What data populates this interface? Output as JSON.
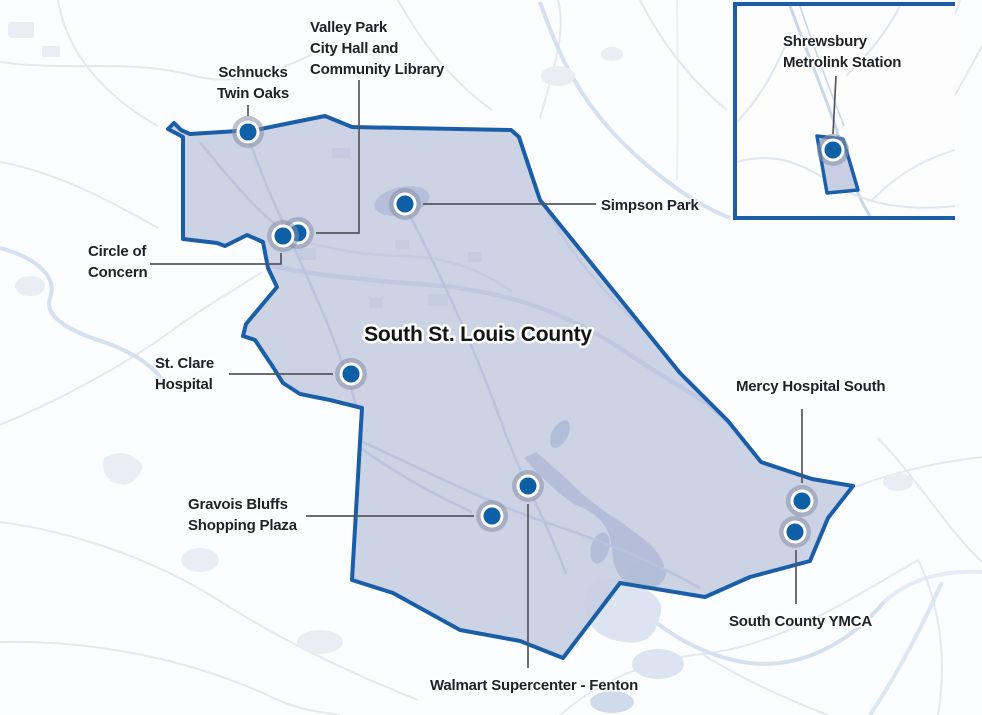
{
  "map": {
    "region": {
      "name": "South St. Louis County",
      "fill_color": "#c8cfe3",
      "border_color": "#1a5ea8",
      "boundary_points": [
        [
          168,
          129
        ],
        [
          174,
          123
        ],
        [
          181,
          130
        ],
        [
          190,
          134
        ],
        [
          238,
          131
        ],
        [
          247,
          136
        ],
        [
          256,
          130
        ],
        [
          290,
          123
        ],
        [
          325,
          116
        ],
        [
          352,
          127
        ],
        [
          511,
          130
        ],
        [
          519,
          137
        ],
        [
          540,
          200
        ],
        [
          680,
          373
        ],
        [
          728,
          421
        ],
        [
          761,
          462
        ],
        [
          812,
          479
        ],
        [
          853,
          486
        ],
        [
          828,
          518
        ],
        [
          810,
          561
        ],
        [
          750,
          577
        ],
        [
          705,
          597
        ],
        [
          620,
          583
        ],
        [
          563,
          658
        ],
        [
          520,
          641
        ],
        [
          460,
          630
        ],
        [
          393,
          593
        ],
        [
          352,
          580
        ],
        [
          362,
          408
        ],
        [
          330,
          400
        ],
        [
          300,
          394
        ],
        [
          283,
          383
        ],
        [
          273,
          367
        ],
        [
          255,
          340
        ],
        [
          243,
          336
        ],
        [
          246,
          324
        ],
        [
          277,
          287
        ],
        [
          268,
          268
        ],
        [
          263,
          242
        ],
        [
          247,
          235
        ],
        [
          225,
          246
        ],
        [
          217,
          243
        ],
        [
          183,
          239
        ],
        [
          183,
          137
        ]
      ]
    },
    "marker_style": {
      "dot_color": "#0d5fa6",
      "ring_color": "#ffffff",
      "halo_color": "rgba(134,143,167,0.55)",
      "dot_radius": 8.5,
      "ring_radius": 11.5,
      "halo_radius": 16
    },
    "leader_color": "#55585c",
    "label_color": "#1f2124",
    "markers": [
      {
        "id": "schnucks-twin-oaks",
        "label_lines": [
          "Schnucks",
          "Twin Oaks"
        ],
        "x": 248,
        "y": 132,
        "label_x": 253,
        "label_y": 77,
        "anchor": "middle",
        "leader": "248,105 248,116"
      },
      {
        "id": "valley-park-city-hall",
        "label_lines": [
          "Valley Park",
          "City Hall and",
          "Community Library"
        ],
        "x": 298,
        "y": 233,
        "label_x": 310,
        "label_y": 32,
        "anchor": "start",
        "leader": "359,80 359,233 316,233"
      },
      {
        "id": "simpson-park",
        "label_lines": [
          "Simpson Park"
        ],
        "x": 405,
        "y": 204,
        "label_x": 601,
        "label_y": 210,
        "anchor": "start",
        "leader": "423,204 596,204"
      },
      {
        "id": "circle-of-concern",
        "label_lines": [
          "Circle of",
          "Concern"
        ],
        "x": 283,
        "y": 236,
        "label_x": 88,
        "label_y": 256,
        "anchor": "start",
        "leader": "150,264 281,264 281,253"
      },
      {
        "id": "st-clare-hospital",
        "label_lines": [
          "St. Clare",
          "Hospital"
        ],
        "x": 351,
        "y": 374,
        "label_x": 155,
        "label_y": 368,
        "anchor": "start",
        "leader": "229,374 333,374"
      },
      {
        "id": "gravois-bluffs-shopping-plaza",
        "label_lines": [
          "Gravois Bluffs",
          "Shopping Plaza"
        ],
        "x": 492,
        "y": 516,
        "label_x": 188,
        "label_y": 509,
        "anchor": "start",
        "leader": "306,516 474,516"
      },
      {
        "id": "walmart-supercenter-fenton",
        "label_lines": [
          "Walmart Supercenter - Fenton"
        ],
        "x": 528,
        "y": 486,
        "label_x": 430,
        "label_y": 690,
        "anchor": "start",
        "leader": "528,504 528,668"
      },
      {
        "id": "mercy-hospital-south",
        "label_lines": [
          "Mercy Hospital South"
        ],
        "x": 802,
        "y": 501,
        "label_x": 736,
        "label_y": 391,
        "anchor": "start",
        "leader": "802,409 802,483"
      },
      {
        "id": "south-county-ymca",
        "label_lines": [
          "South County YMCA"
        ],
        "x": 795,
        "y": 532,
        "label_x": 729,
        "label_y": 626,
        "anchor": "start",
        "leader": "796,550 796,604"
      }
    ]
  },
  "inset": {
    "border_color": "#1a5ea8",
    "region_fill": "#c8cfe3",
    "region_points": [
      [
        817,
        136
      ],
      [
        843,
        139
      ],
      [
        858,
        190
      ],
      [
        827,
        193
      ]
    ],
    "marker": {
      "id": "shrewsbury-metrolink-station",
      "label_lines": [
        "Shrewsbury",
        "Metrolink Station"
      ],
      "x": 833,
      "y": 150,
      "label_x": 783,
      "label_y": 46,
      "anchor": "start",
      "leader": "836,76 833,134"
    }
  }
}
